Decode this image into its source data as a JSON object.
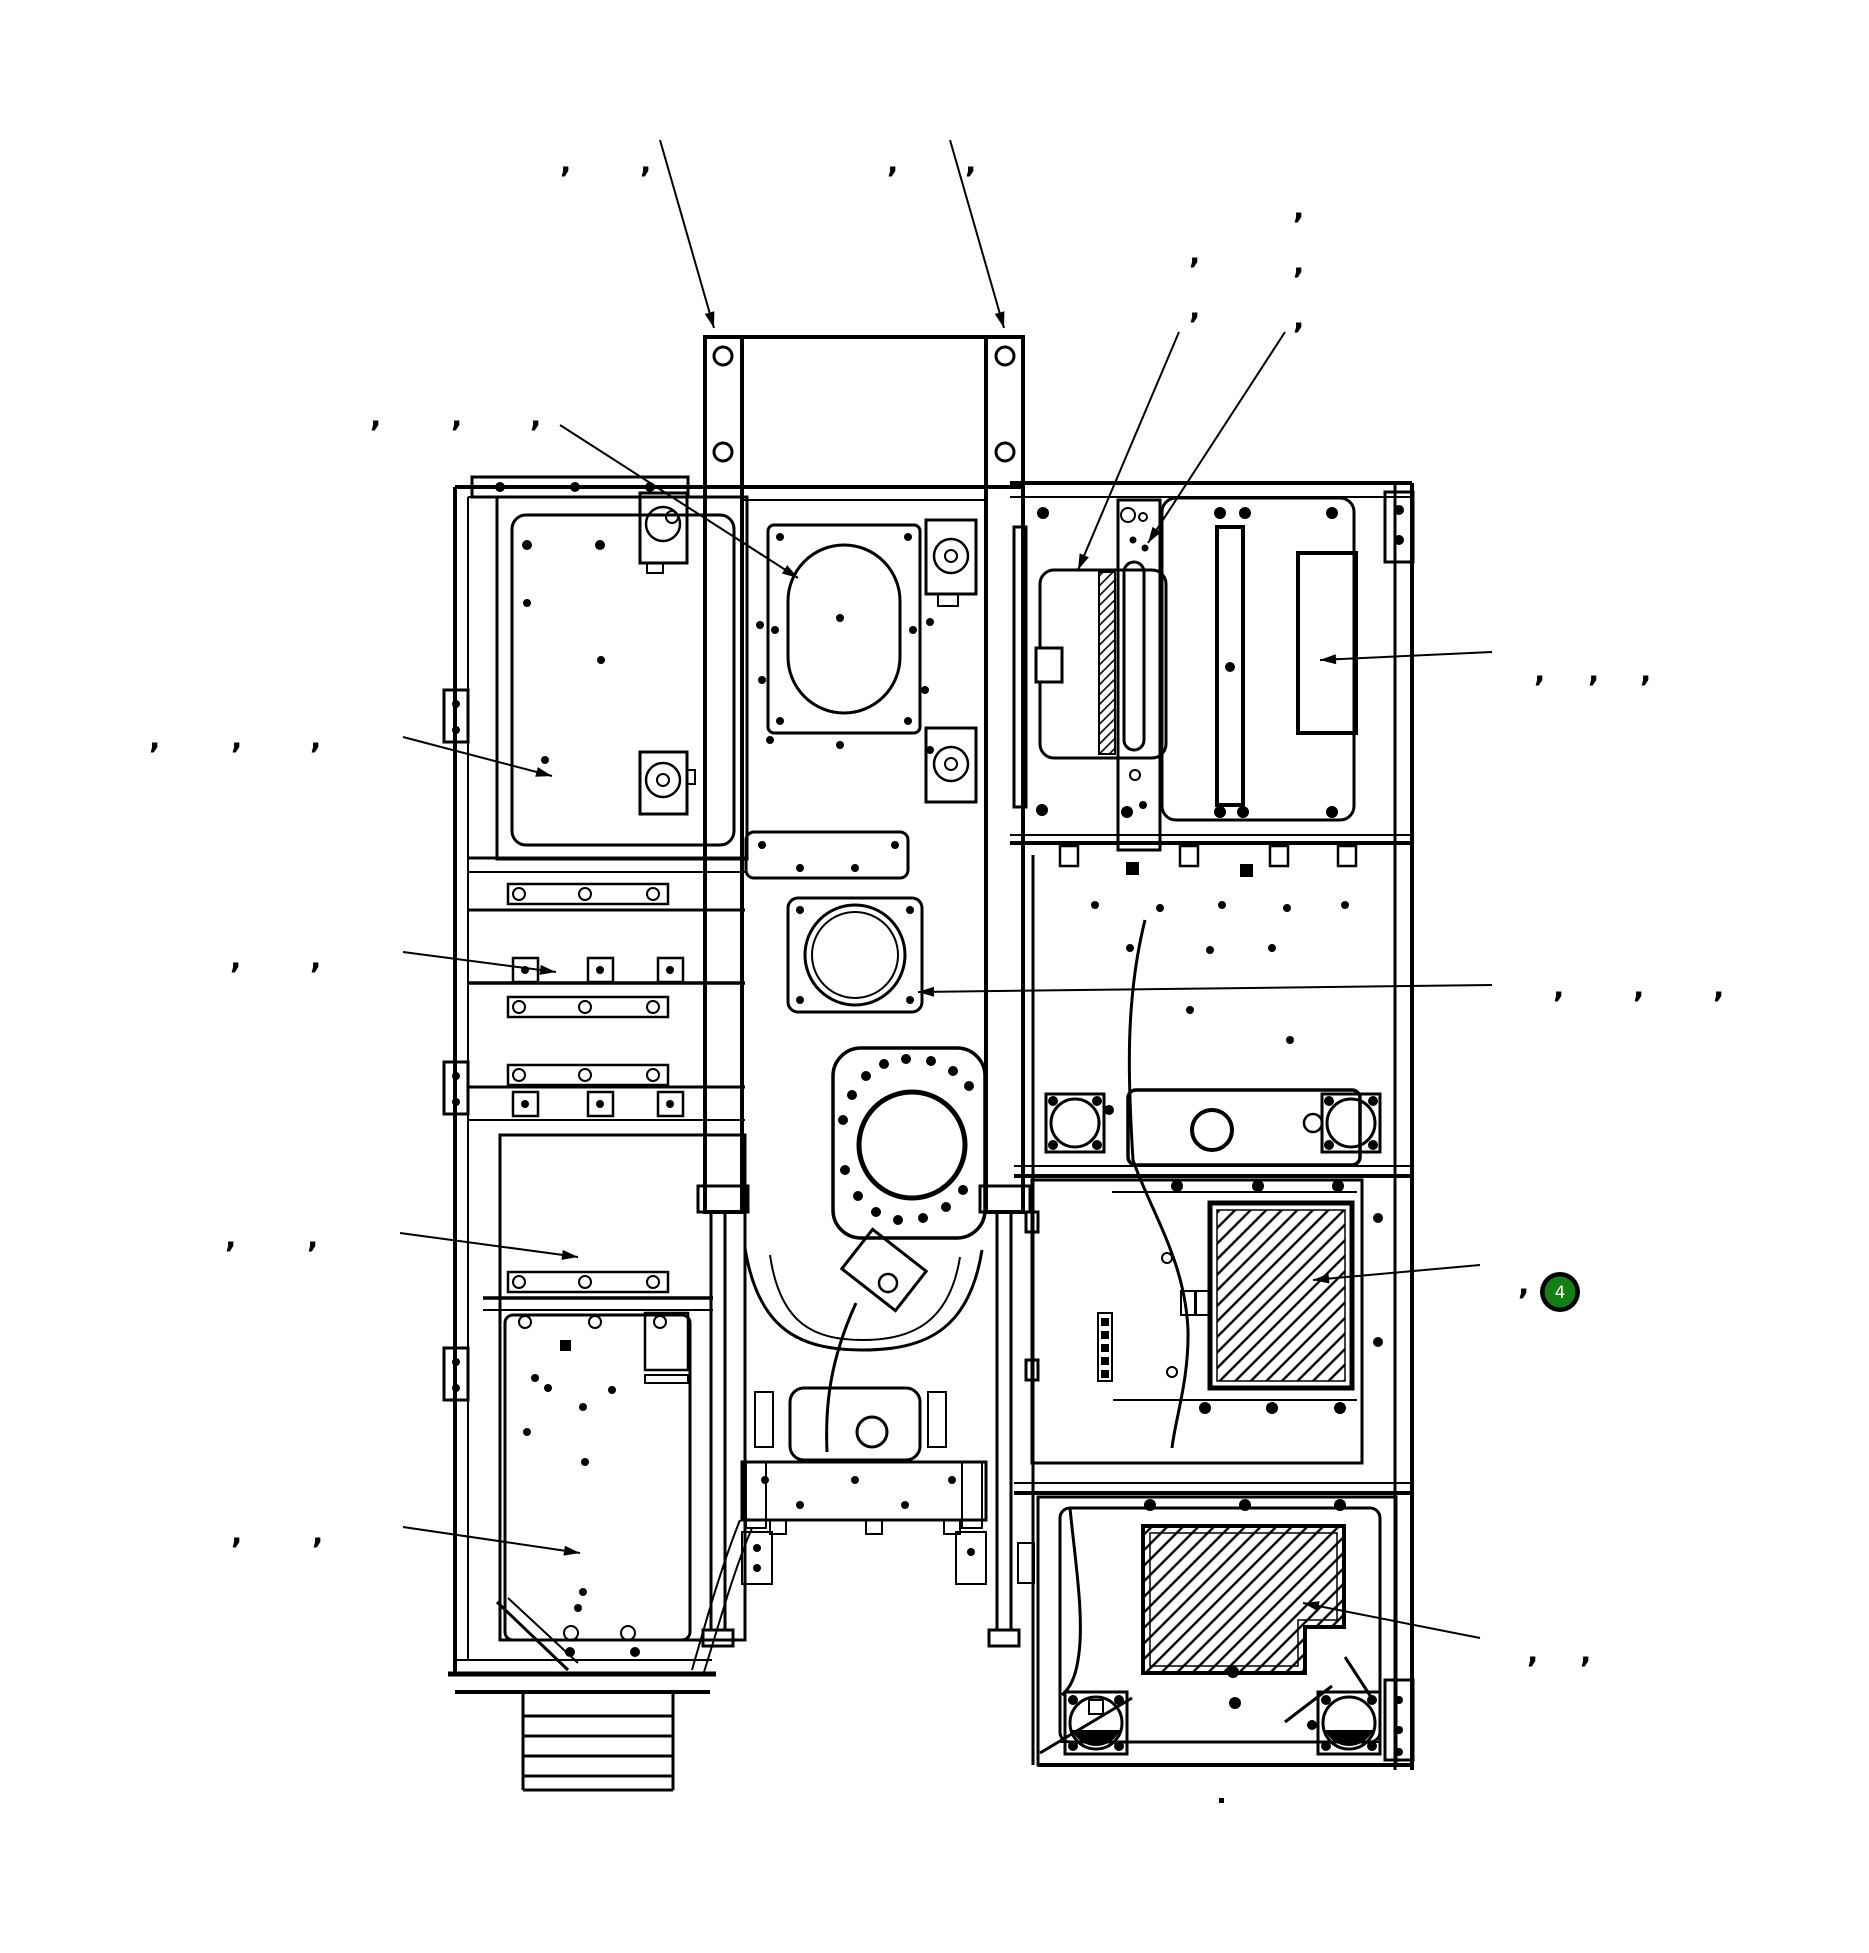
{
  "diagram": {
    "kind": "mechanical-assembly-exploded-view",
    "comma_char": ",",
    "comma_labels": [
      {
        "x": 560,
        "y": 172
      },
      {
        "x": 640,
        "y": 172
      },
      {
        "x": 887,
        "y": 172
      },
      {
        "x": 965,
        "y": 172
      },
      {
        "x": 1293,
        "y": 218
      },
      {
        "x": 1189,
        "y": 263
      },
      {
        "x": 1293,
        "y": 273
      },
      {
        "x": 1189,
        "y": 318
      },
      {
        "x": 1293,
        "y": 328
      },
      {
        "x": 370,
        "y": 426
      },
      {
        "x": 451,
        "y": 426
      },
      {
        "x": 530,
        "y": 426
      },
      {
        "x": 149,
        "y": 748
      },
      {
        "x": 231,
        "y": 748
      },
      {
        "x": 310,
        "y": 748
      },
      {
        "x": 230,
        "y": 968
      },
      {
        "x": 310,
        "y": 968
      },
      {
        "x": 225,
        "y": 1247
      },
      {
        "x": 307,
        "y": 1247
      },
      {
        "x": 231,
        "y": 1543
      },
      {
        "x": 312,
        "y": 1543
      },
      {
        "x": 1534,
        "y": 681
      },
      {
        "x": 1588,
        "y": 681
      },
      {
        "x": 1640,
        "y": 681
      },
      {
        "x": 1553,
        "y": 997
      },
      {
        "x": 1633,
        "y": 997
      },
      {
        "x": 1713,
        "y": 997
      },
      {
        "x": 1518,
        "y": 1294
      },
      {
        "x": 1527,
        "y": 1662
      },
      {
        "x": 1580,
        "y": 1662
      }
    ],
    "leaders": [
      {
        "x1": 660,
        "y1": 140,
        "x2": 714,
        "y2": 328
      },
      {
        "x1": 950,
        "y1": 140,
        "x2": 1004,
        "y2": 328
      },
      {
        "x1": 1179,
        "y1": 332,
        "x2": 1078,
        "y2": 570
      },
      {
        "x1": 1285,
        "y1": 332,
        "x2": 1148,
        "y2": 543
      },
      {
        "x1": 560,
        "y1": 425,
        "x2": 798,
        "y2": 578
      },
      {
        "x1": 403,
        "y1": 737,
        "x2": 552,
        "y2": 776
      },
      {
        "x1": 403,
        "y1": 952,
        "x2": 556,
        "y2": 972
      },
      {
        "x1": 400,
        "y1": 1233,
        "x2": 578,
        "y2": 1257
      },
      {
        "x1": 403,
        "y1": 1527,
        "x2": 580,
        "y2": 1553
      },
      {
        "x1": 1492,
        "y1": 985,
        "x2": 918,
        "y2": 992
      },
      {
        "x1": 1492,
        "y1": 652,
        "x2": 1320,
        "y2": 660
      },
      {
        "x1": 1480,
        "y1": 1265,
        "x2": 1313,
        "y2": 1280
      },
      {
        "x1": 1480,
        "y1": 1638,
        "x2": 1303,
        "y2": 1603
      }
    ],
    "badge": {
      "label": "4",
      "x": 1560,
      "y": 1292,
      "ring_color": "#000000",
      "fill": "#128012",
      "text_color": "#ffffff"
    },
    "stray_dot": {
      "x": 1221,
      "y": 1800
    },
    "line_color": "#000000",
    "background": "#ffffff"
  }
}
